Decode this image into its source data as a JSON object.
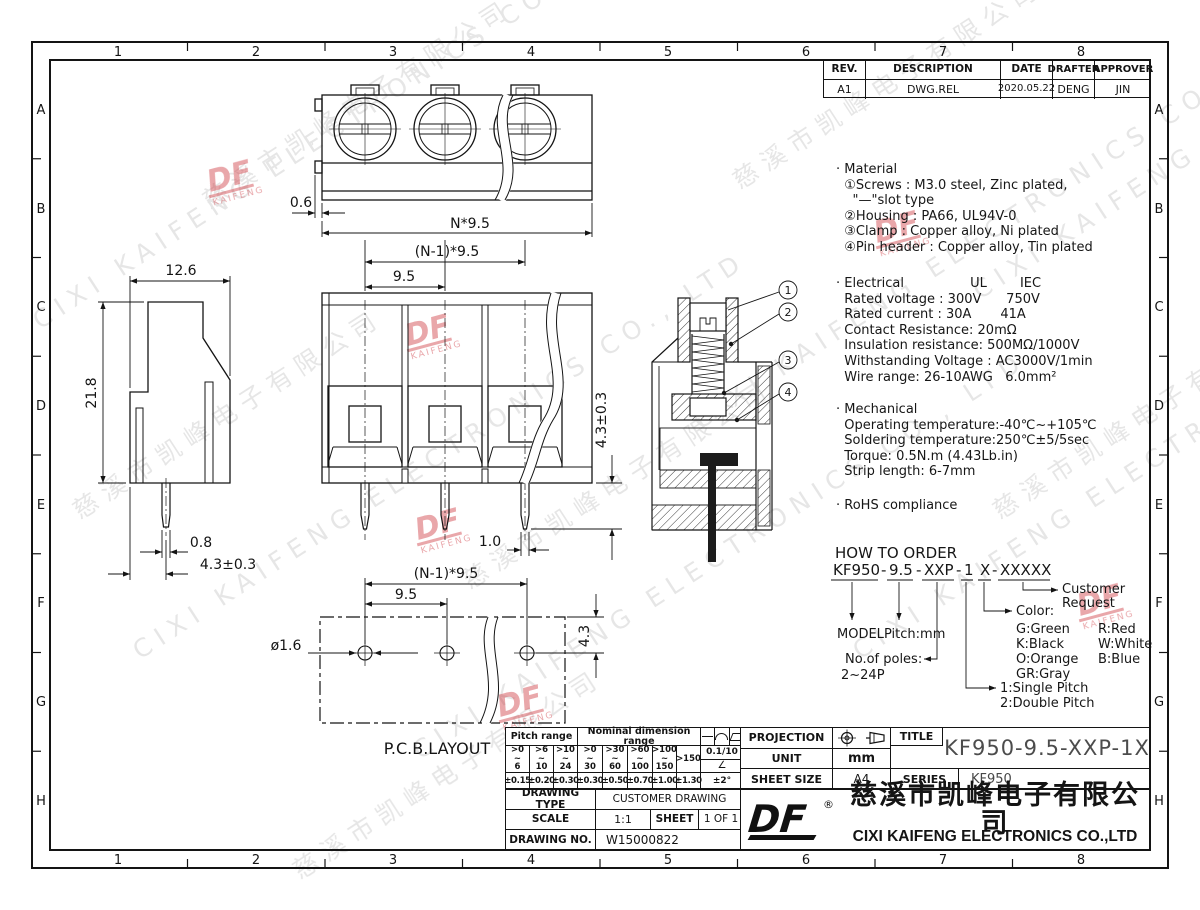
{
  "border": {
    "cols": [
      "1",
      "2",
      "3",
      "4",
      "5",
      "6",
      "7",
      "8"
    ],
    "rows": [
      "A",
      "B",
      "C",
      "D",
      "E",
      "F",
      "G",
      "H"
    ]
  },
  "revision": {
    "headers": [
      "REV.",
      "DESCRIPTION",
      "DATE",
      "DRAFTER",
      "APPROVER"
    ],
    "row": [
      "A1",
      "DWG.REL",
      "2020.05.22",
      "DENG",
      "JIN"
    ]
  },
  "notes": {
    "material": [
      "· Material",
      "  ①Screws : M3.0 steel, Zinc plated,",
      "    \"—\"slot type",
      "  ②Housing : PA66, UL94V-0",
      "  ③Clamp : Copper alloy, Ni plated",
      "  ④Pin header : Copper alloy, Tin plated"
    ],
    "electrical": [
      "· Electrical                UL        IEC",
      "  Rated voltage : 300V      750V",
      "  Rated current : 30A       41A",
      "  Contact Resistance: 20mΩ",
      "  Insulation resistance: 500MΩ/1000V",
      "  Withstanding Voltage : AC3000V/1min",
      "  Wire range: 26-10AWG   6.0mm²"
    ],
    "mechanical": [
      "· Mechanical",
      "  Operating temperature:-40℃~+105℃",
      "  Soldering temperature:250℃±5/5sec",
      "  Torque: 0.5N.m (4.43Lb.in)",
      "  Strip length: 6-7mm"
    ],
    "rohs": "· RoHS compliance"
  },
  "order": {
    "title": "HOW TO ORDER",
    "code_parts": [
      "KF950",
      "9.5",
      "XXP",
      "1",
      "X",
      "XXXXX"
    ],
    "sep": "-",
    "model": "MODEL",
    "pitch": "Pitch:mm",
    "poles_label": "No.of poles:",
    "poles_range": "2~24P",
    "pitch1": "1:Single Pitch",
    "pitch2": "2:Double Pitch",
    "color_label": "Color:",
    "colors_left": [
      "G:Green",
      "K:Black",
      "O:Orange",
      "GR:Gray"
    ],
    "colors_right": [
      "R:Red",
      "W:White",
      "B:Blue"
    ],
    "customer1": "Customer",
    "customer2": "Request"
  },
  "dims": {
    "top_gap": "0.6",
    "top_total": "N*9.5",
    "top_n1": "(N-1)*9.5",
    "top_pitch": "9.5",
    "side_width": "12.6",
    "side_height": "21.8",
    "side_pin_w": "0.8",
    "side_pin_len": "4.3±0.3",
    "front_pin_len": "4.3±0.3",
    "front_pin_w": "1.0",
    "pcb_n1": "(N-1)*9.5",
    "pcb_pitch": "9.5",
    "pcb_hole": "ø1.6",
    "pcb_edge": "4.3",
    "pcb_label": "P.C.B.LAYOUT"
  },
  "callouts": [
    "1",
    "2",
    "3",
    "4"
  ],
  "tol": {
    "pitch_label": "Pitch range",
    "nominal_label": "Nominal dimension range",
    "ranges": [
      ">0\n~\n6",
      ">6\n~\n10",
      ">10\n~\n24",
      ">0\n~\n30",
      ">30\n~\n60",
      ">60\n~\n100",
      ">100\n~\n150",
      ">150"
    ],
    "tols": [
      "±0.15",
      "±0.20",
      "±0.30",
      "±0.30",
      "±0.50",
      "±0.70",
      "±1.00",
      "±1.30"
    ],
    "special_top": "0.1/10",
    "special_mid": "∠",
    "special_bot": "±2°"
  },
  "icons": {
    "tolerance_symbols": [
      "straightness-line",
      "arc",
      "parallelogram"
    ],
    "projection_symbol": "first-angle-projection"
  },
  "titleblock": {
    "projection_label": "PROJECTION",
    "unit_label": "UNIT",
    "unit_value": "mm",
    "sheet_size_label": "SHEET SIZE",
    "sheet_size_value": "A4",
    "title_label": "TITLE",
    "title_value": "KF950-9.5-XXP-1X",
    "series_label": "SERIES",
    "series_value": "KF950",
    "drawing_type_label": "DRAWING TYPE",
    "drawing_type_value": "CUSTOMER DRAWING",
    "scale_label": "SCALE",
    "scale_value": "1:1",
    "sheet_label": "SHEET",
    "sheet_value": "1 OF 1",
    "drawing_no_label": "DRAWING NO.",
    "drawing_no_value": "W15000822"
  },
  "company": {
    "logo": "DF",
    "registered": "®",
    "name_cn": "慈溪市凯峰电子有限公司",
    "name_en": "CIXI KAIFENG ELECTRONICS CO.,LTD"
  },
  "wm": {
    "cn": "慈溪市凯峰电子有限公司",
    "en": "CIXI KAIFENG ELECTRONICS CO., LTD",
    "logo": "DF",
    "logo_sub": "KAIFENG",
    "logo_color": "#cf3a42"
  }
}
